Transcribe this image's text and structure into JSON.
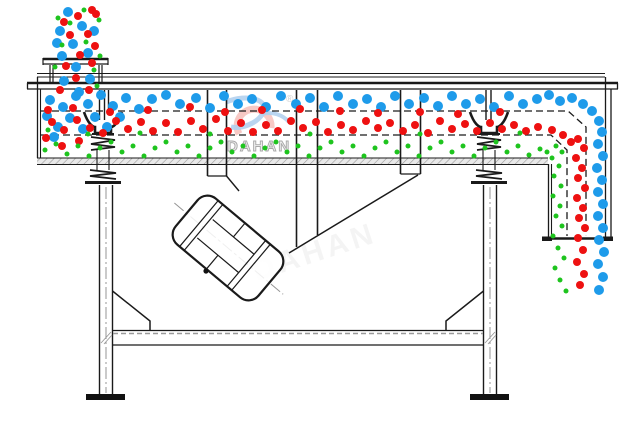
{
  "watermark": {
    "brand_text": "DAHAN",
    "registered_mark": "®",
    "faint_text": "DAHAN"
  },
  "colors": {
    "line": "#1a1a1a",
    "grey_centerline": "#949494",
    "particle_large_blue": "#1e9bea",
    "particle_medium_red": "#ee1111",
    "particle_small_green": "#1ec41e",
    "logo_red": "#f0968f",
    "logo_blue": "#7fb0e2",
    "brand_text_fill": "#ededed",
    "brand_text_stroke": "#a8a8a8"
  },
  "particle_sizes": {
    "large": 5,
    "medium": 4,
    "small": 2.5
  },
  "particles": {
    "large_blue": [
      [
        68,
        12
      ],
      [
        82,
        26
      ],
      [
        60,
        31
      ],
      [
        94,
        31
      ],
      [
        57,
        43
      ],
      [
        73,
        44
      ],
      [
        88,
        53
      ],
      [
        62,
        56
      ],
      [
        76,
        67
      ],
      [
        90,
        79
      ],
      [
        64,
        81
      ],
      [
        79,
        92
      ],
      [
        50,
        100
      ],
      [
        63,
        107
      ],
      [
        76,
        96
      ],
      [
        88,
        104
      ],
      [
        101,
        95
      ],
      [
        113,
        106
      ],
      [
        126,
        98
      ],
      [
        139,
        109
      ],
      [
        152,
        99
      ],
      [
        166,
        95
      ],
      [
        180,
        104
      ],
      [
        196,
        98
      ],
      [
        210,
        108
      ],
      [
        224,
        96
      ],
      [
        238,
        104
      ],
      [
        252,
        99
      ],
      [
        266,
        107
      ],
      [
        281,
        96
      ],
      [
        296,
        104
      ],
      [
        310,
        98
      ],
      [
        324,
        107
      ],
      [
        338,
        96
      ],
      [
        353,
        104
      ],
      [
        367,
        99
      ],
      [
        381,
        107
      ],
      [
        395,
        96
      ],
      [
        409,
        104
      ],
      [
        424,
        98
      ],
      [
        438,
        106
      ],
      [
        452,
        96
      ],
      [
        466,
        104
      ],
      [
        480,
        99
      ],
      [
        494,
        107
      ],
      [
        509,
        96
      ],
      [
        523,
        104
      ],
      [
        537,
        99
      ],
      [
        549,
        95
      ],
      [
        560,
        101
      ],
      [
        572,
        98
      ],
      [
        583,
        104
      ],
      [
        592,
        111
      ],
      [
        599,
        121
      ],
      [
        602,
        132
      ],
      [
        47,
        116
      ],
      [
        58,
        127
      ],
      [
        70,
        118
      ],
      [
        83,
        129
      ],
      [
        95,
        117
      ],
      [
        107,
        127
      ],
      [
        120,
        117
      ],
      [
        54,
        137
      ],
      [
        598,
        144
      ],
      [
        603,
        156
      ],
      [
        597,
        168
      ],
      [
        602,
        180
      ],
      [
        598,
        192
      ],
      [
        603,
        204
      ],
      [
        598,
        216
      ],
      [
        603,
        228
      ],
      [
        599,
        240
      ],
      [
        604,
        252
      ],
      [
        598,
        264
      ],
      [
        603,
        277
      ],
      [
        599,
        290
      ]
    ],
    "medium_red": [
      [
        92,
        10
      ],
      [
        96,
        14
      ],
      [
        78,
        16
      ],
      [
        64,
        22
      ],
      [
        88,
        34
      ],
      [
        70,
        35
      ],
      [
        95,
        46
      ],
      [
        80,
        55
      ],
      [
        66,
        66
      ],
      [
        92,
        63
      ],
      [
        76,
        78
      ],
      [
        60,
        90
      ],
      [
        89,
        90
      ],
      [
        48,
        110
      ],
      [
        73,
        108
      ],
      [
        110,
        112
      ],
      [
        148,
        110
      ],
      [
        190,
        107
      ],
      [
        225,
        112
      ],
      [
        262,
        110
      ],
      [
        300,
        109
      ],
      [
        340,
        111
      ],
      [
        378,
        113
      ],
      [
        420,
        112
      ],
      [
        458,
        114
      ],
      [
        500,
        112
      ],
      [
        52,
        122
      ],
      [
        64,
        130
      ],
      [
        77,
        120
      ],
      [
        90,
        128
      ],
      [
        103,
        133
      ],
      [
        116,
        121
      ],
      [
        128,
        129
      ],
      [
        141,
        122
      ],
      [
        153,
        131
      ],
      [
        166,
        123
      ],
      [
        178,
        132
      ],
      [
        191,
        121
      ],
      [
        203,
        129
      ],
      [
        216,
        119
      ],
      [
        228,
        131
      ],
      [
        241,
        123
      ],
      [
        253,
        132
      ],
      [
        266,
        125
      ],
      [
        278,
        131
      ],
      [
        291,
        121
      ],
      [
        303,
        128
      ],
      [
        316,
        122
      ],
      [
        328,
        132
      ],
      [
        341,
        125
      ],
      [
        353,
        130
      ],
      [
        366,
        121
      ],
      [
        378,
        128
      ],
      [
        390,
        123
      ],
      [
        403,
        131
      ],
      [
        415,
        125
      ],
      [
        428,
        133
      ],
      [
        440,
        121
      ],
      [
        452,
        129
      ],
      [
        465,
        124
      ],
      [
        477,
        131
      ],
      [
        490,
        123
      ],
      [
        502,
        129
      ],
      [
        514,
        125
      ],
      [
        526,
        131
      ],
      [
        538,
        127
      ],
      [
        46,
        138
      ],
      [
        62,
        146
      ],
      [
        79,
        141
      ],
      [
        552,
        130
      ],
      [
        563,
        135
      ],
      [
        571,
        142
      ],
      [
        578,
        139
      ],
      [
        584,
        148
      ],
      [
        576,
        158
      ],
      [
        582,
        168
      ],
      [
        578,
        178
      ],
      [
        585,
        188
      ],
      [
        577,
        198
      ],
      [
        583,
        208
      ],
      [
        579,
        218
      ],
      [
        585,
        228
      ],
      [
        578,
        238
      ],
      [
        583,
        250
      ],
      [
        577,
        262
      ],
      [
        584,
        274
      ],
      [
        580,
        285
      ]
    ],
    "small_green": [
      [
        84,
        10
      ],
      [
        58,
        18
      ],
      [
        99,
        20
      ],
      [
        70,
        23
      ],
      [
        86,
        42
      ],
      [
        62,
        45
      ],
      [
        100,
        56
      ],
      [
        94,
        70
      ],
      [
        55,
        67
      ],
      [
        97,
        86
      ],
      [
        48,
        130
      ],
      [
        88,
        134
      ],
      [
        140,
        133
      ],
      [
        210,
        134
      ],
      [
        310,
        134
      ],
      [
        420,
        134
      ],
      [
        520,
        133
      ],
      [
        45,
        150
      ],
      [
        56,
        144
      ],
      [
        67,
        154
      ],
      [
        78,
        146
      ],
      [
        89,
        156
      ],
      [
        100,
        148
      ],
      [
        111,
        142
      ],
      [
        122,
        152
      ],
      [
        133,
        146
      ],
      [
        144,
        156
      ],
      [
        155,
        148
      ],
      [
        166,
        142
      ],
      [
        177,
        152
      ],
      [
        188,
        146
      ],
      [
        199,
        156
      ],
      [
        210,
        148
      ],
      [
        221,
        142
      ],
      [
        232,
        152
      ],
      [
        243,
        146
      ],
      [
        254,
        156
      ],
      [
        265,
        148
      ],
      [
        276,
        142
      ],
      [
        287,
        152
      ],
      [
        298,
        146
      ],
      [
        309,
        156
      ],
      [
        320,
        148
      ],
      [
        331,
        142
      ],
      [
        342,
        152
      ],
      [
        353,
        146
      ],
      [
        364,
        156
      ],
      [
        375,
        148
      ],
      [
        386,
        142
      ],
      [
        397,
        152
      ],
      [
        408,
        146
      ],
      [
        419,
        156
      ],
      [
        430,
        148
      ],
      [
        441,
        142
      ],
      [
        452,
        152
      ],
      [
        463,
        146
      ],
      [
        474,
        156
      ],
      [
        485,
        148
      ],
      [
        496,
        142
      ],
      [
        507,
        152
      ],
      [
        518,
        146
      ],
      [
        529,
        155
      ],
      [
        540,
        149
      ],
      [
        547,
        152
      ],
      [
        556,
        146
      ],
      [
        562,
        152
      ],
      [
        552,
        158
      ],
      [
        559,
        166
      ],
      [
        554,
        176
      ],
      [
        561,
        186
      ],
      [
        553,
        196
      ],
      [
        560,
        206
      ],
      [
        556,
        216
      ],
      [
        562,
        226
      ],
      [
        553,
        236
      ],
      [
        558,
        248
      ],
      [
        564,
        258
      ],
      [
        555,
        268
      ],
      [
        560,
        280
      ],
      [
        566,
        291
      ]
    ]
  }
}
